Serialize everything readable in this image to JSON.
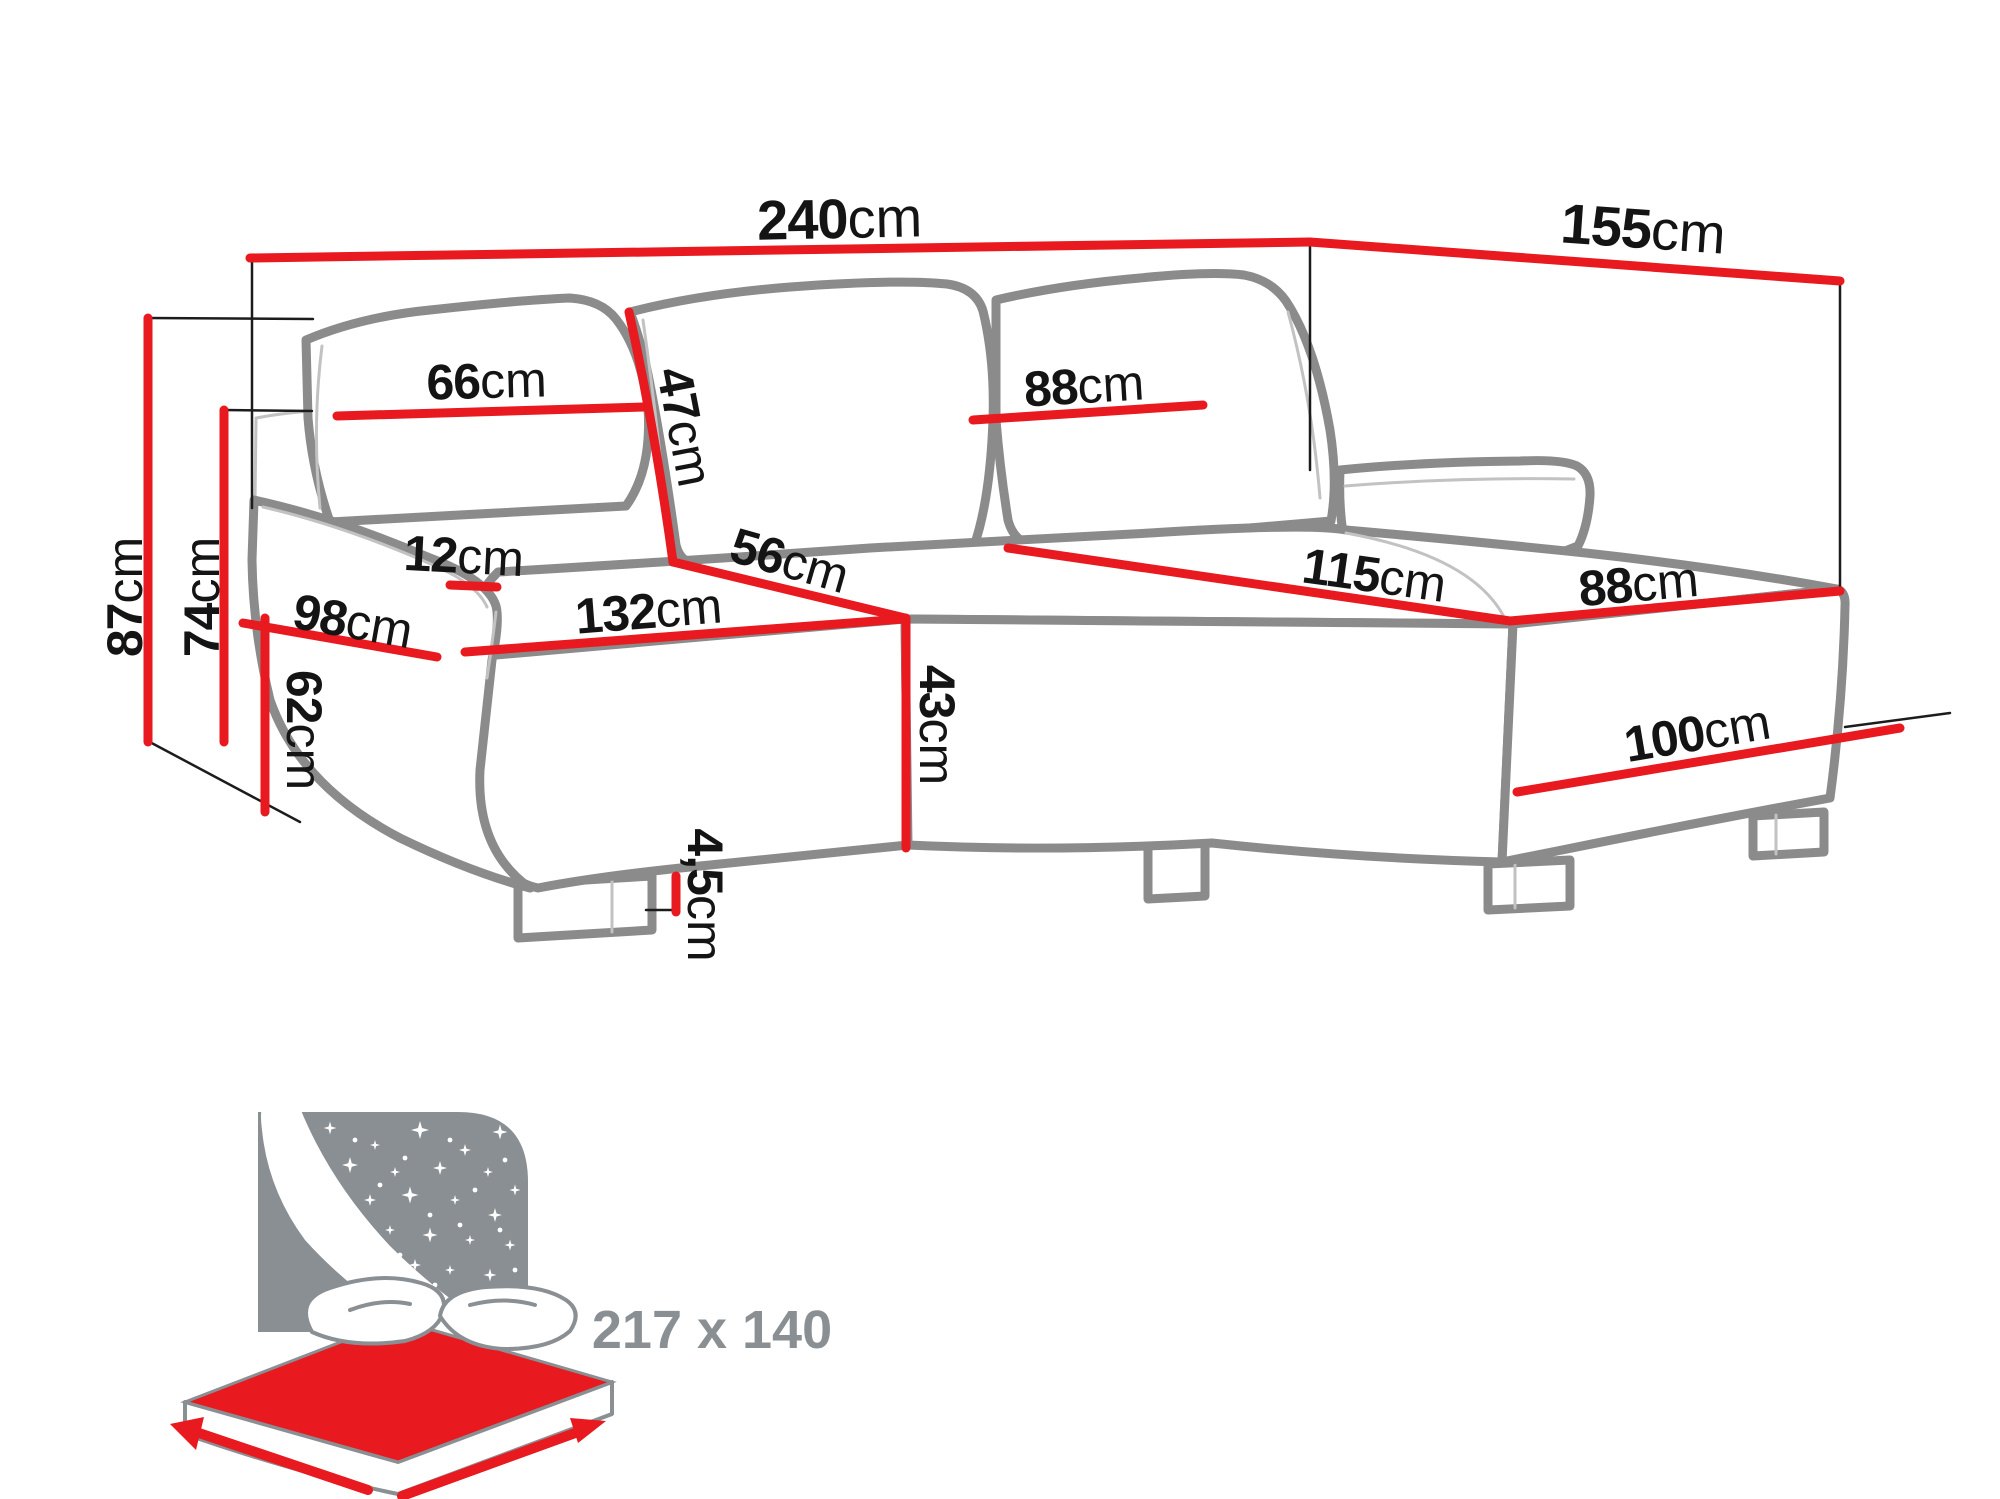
{
  "dims": {
    "d240": {
      "value": "240",
      "unit": "cm"
    },
    "d155": {
      "value": "155",
      "unit": "cm"
    },
    "d87": {
      "value": "87",
      "unit": "cm"
    },
    "d74": {
      "value": "74",
      "unit": "cm"
    },
    "d66": {
      "value": "66",
      "unit": "cm"
    },
    "d47": {
      "value": "47",
      "unit": "cm"
    },
    "d88_back": {
      "value": "88",
      "unit": "cm"
    },
    "d12": {
      "value": "12",
      "unit": "cm"
    },
    "d98": {
      "value": "98",
      "unit": "cm"
    },
    "d132": {
      "value": "132",
      "unit": "cm"
    },
    "d56": {
      "value": "56",
      "unit": "cm"
    },
    "d43": {
      "value": "43",
      "unit": "cm"
    },
    "d62": {
      "value": "62",
      "unit": "cm"
    },
    "d115": {
      "value": "115",
      "unit": "cm"
    },
    "d88_chaise": {
      "value": "88",
      "unit": "cm"
    },
    "d100": {
      "value": "100",
      "unit": "cm"
    },
    "d45": {
      "value": "4,5",
      "unit": "cm"
    }
  },
  "sleeping_area": {
    "label": "217 x 140"
  },
  "colors": {
    "dimension_red": "#e8191f",
    "outline_gray": "#8b8b8b",
    "label_black": "#141414",
    "icon_gray": "#8a8f93"
  }
}
